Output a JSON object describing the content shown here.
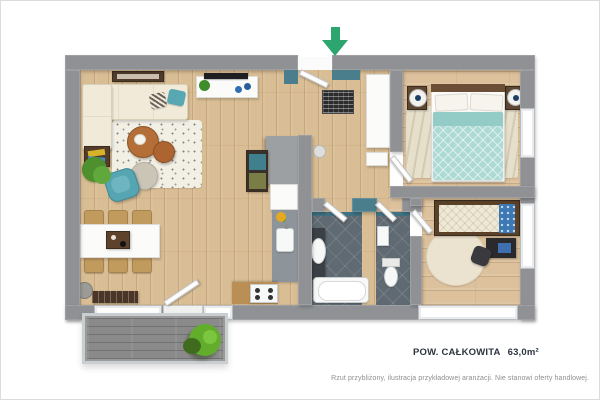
{
  "meta": {
    "kind": "3d-apartment-floor-plan",
    "language": "pl"
  },
  "annotations": {
    "area_label": "POW. CAŁKOWITA",
    "area_value": "63,0m²",
    "disclaimer": "Rzut przybliżony, ilustracja przykładowej aranżacji. Nie stanowi oferty handlowej."
  },
  "entrance": {
    "icon": "entrance-arrow-down-icon",
    "color": "#2da56e"
  },
  "palette": {
    "wall": "#8f9194",
    "teal_accent_wall": "#4a7e8c",
    "wood_floor_living": "#d9bd94",
    "wood_floor_bedroom": "#dcc19c",
    "bathroom_tile": "#606a72",
    "balcony_deck": "#8a8a8a",
    "sofa_cream": "#f1ead8",
    "armchair_teal": "#55a5b2",
    "bedding_teal": "#aedad5",
    "kids_pillow_blue": "#3c78b4",
    "coffee_table_wood": "#b46e38",
    "plant_green": "#5ea035",
    "area_text": "#2e3440",
    "disclaimer_text": "#8f8f8f"
  },
  "rooms": [
    {
      "name": "living-dining-kitchen"
    },
    {
      "name": "entrance-hall"
    },
    {
      "name": "master-bedroom"
    },
    {
      "name": "bathroom"
    },
    {
      "name": "wc"
    },
    {
      "name": "kids-bedroom"
    },
    {
      "name": "balcony"
    }
  ]
}
